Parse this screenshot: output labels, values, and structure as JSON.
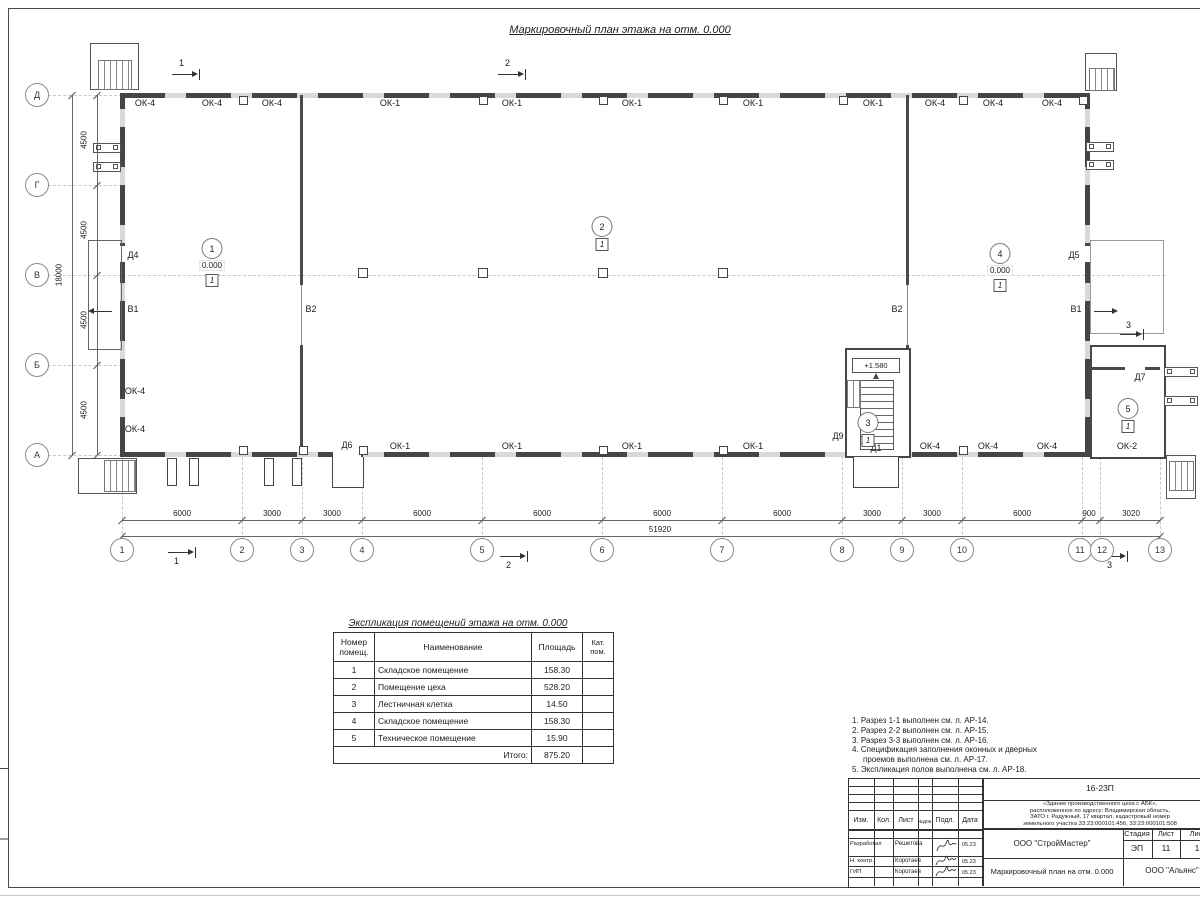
{
  "page": {
    "title": "Маркировочный план этажа на отм. 0.000"
  },
  "plan": {
    "axis_letters": [
      "Д",
      "Г",
      "В",
      "Б",
      "А"
    ],
    "axis_numbers": [
      "1",
      "2",
      "3",
      "4",
      "5",
      "6",
      "7",
      "8",
      "9",
      "10",
      "11",
      "12",
      "13"
    ],
    "left_dims": [
      "4500",
      "4500",
      "4500",
      "4500"
    ],
    "left_total": "18000",
    "bottom_dims": [
      "6000",
      "3000",
      "3000",
      "6000",
      "6000",
      "6000",
      "6000",
      "3000",
      "3000",
      "6000",
      "900",
      "3020"
    ],
    "bottom_total": "51920",
    "top_windows": [
      "ОК-4",
      "ОК-4",
      "ОК-4",
      "ОК-1",
      "ОК-1",
      "ОК-1",
      "ОК-1",
      "ОК-1",
      "ОК-4",
      "ОК-4",
      "ОК-4"
    ],
    "bottom_windows": [
      "ОК-1",
      "ОК-1",
      "ОК-1",
      "ОК-1",
      "ОК-4",
      "ОК-4",
      "ОК-4",
      "ОК-2"
    ],
    "left_windows": [
      "ОК-4",
      "ОК-4"
    ],
    "doors": {
      "d4": "Д4",
      "d5": "Д5",
      "d6": "Д6",
      "d7": "Д7",
      "d9": "Д9",
      "d1": "Д1"
    },
    "gates": {
      "b1": "В1",
      "b2": "В2"
    },
    "stair_elev": "+1.580",
    "sections": {
      "s1": "1",
      "s2": "2",
      "s3": "3"
    },
    "rooms": [
      {
        "num": "1",
        "elev": "0.000",
        "floor": "1"
      },
      {
        "num": "2",
        "floor": "1"
      },
      {
        "num": "3",
        "floor": "1"
      },
      {
        "num": "4",
        "elev": "0.000",
        "floor": "1"
      },
      {
        "num": "5",
        "floor": "1"
      }
    ]
  },
  "explication": {
    "title": "Экспликация помещений этажа на отм. 0.000",
    "headers": [
      "Номер помещ.",
      "Наименование",
      "Площадь",
      "Кат. пом."
    ],
    "rows": [
      {
        "num": "1",
        "name": "Складское помещение",
        "area": "158.30"
      },
      {
        "num": "2",
        "name": "Помещение цеха",
        "area": "528.20"
      },
      {
        "num": "3",
        "name": "Лестничная клетка",
        "area": "14.50"
      },
      {
        "num": "4",
        "name": "Складское помещение",
        "area": "158.30"
      },
      {
        "num": "5",
        "name": "Техническое помещение",
        "area": "15.90"
      }
    ],
    "total_label": "Итого:",
    "total": "875.20"
  },
  "notes": {
    "lines": [
      "1. Разрез 1-1 выполнен см. л. АР-14.",
      "2. Разрез 2-2 выполнен см. л. АР-15.",
      "3. Разрез 3-3 выполнен см. л. АР-16.",
      "4. Спецификация заполнения оконных и дверных",
      "проемов выполнена см. л. АР-17.",
      "5. Экспликация полов выполнена см. л. АР-18."
    ]
  },
  "titleblock": {
    "doc_number": "16-23П",
    "project_lines": [
      "«Здание производственного цеха с АБК»,",
      "расположенное по адресу: Владимирская область,",
      "ЗАТО г. Радужный, 17 квартал, кадастровый номер",
      "земельного участка 33:23:000101:456, 33:23:000101:508"
    ],
    "cols": [
      "Изм.",
      "Кол.",
      "Лист",
      "№док.",
      "Подл.",
      "Дата"
    ],
    "rows": [
      {
        "role": "Разработал",
        "name": "Решетова",
        "date": "05.23"
      },
      {
        "role": "Н. контр.",
        "name": "Коротаев",
        "date": "05.23"
      },
      {
        "role": "ГИП",
        "name": "Коротаев",
        "date": "05.23"
      }
    ],
    "org": "ООО \"СтройМастер\"",
    "stage_label": "Стадия",
    "sheet_label": "Лист",
    "sheets_label": "Лис",
    "stage": "ЭП",
    "sheet": "11",
    "sheets": "1",
    "drawing_title": "Маркировочный план на отм. 0.000",
    "org2": "ООО \"Альянс\""
  }
}
